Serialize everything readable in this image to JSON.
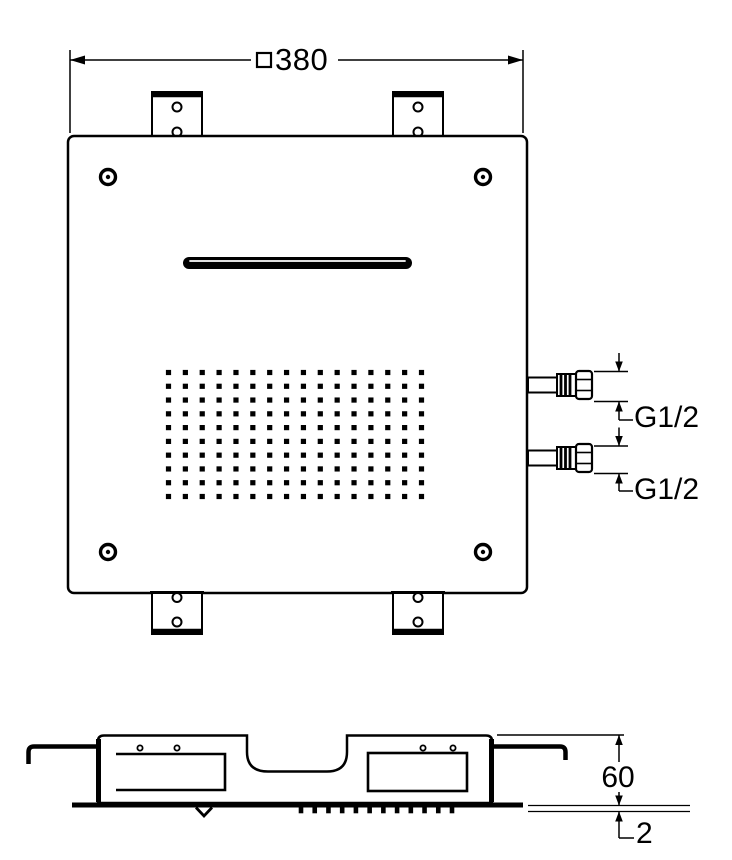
{
  "drawing": {
    "background": "#ffffff",
    "stroke_color": "#000000",
    "subject": "square shower head technical drawing"
  },
  "top_view": {
    "label": "plan view",
    "width_dimension": {
      "symbol_icon": "square-outline",
      "value": "380"
    },
    "connections": [
      {
        "label": "G1/2"
      },
      {
        "label": "G1/2"
      }
    ],
    "spray_grid": {
      "columns": 16,
      "rows": 10
    },
    "screw_count": 4,
    "mounting_bracket_count": 4
  },
  "side_view": {
    "label": "side view",
    "height_dimension": {
      "value": "60"
    },
    "plate_thickness_dimension": {
      "value": "2"
    },
    "nozzle_row_count": 12
  }
}
